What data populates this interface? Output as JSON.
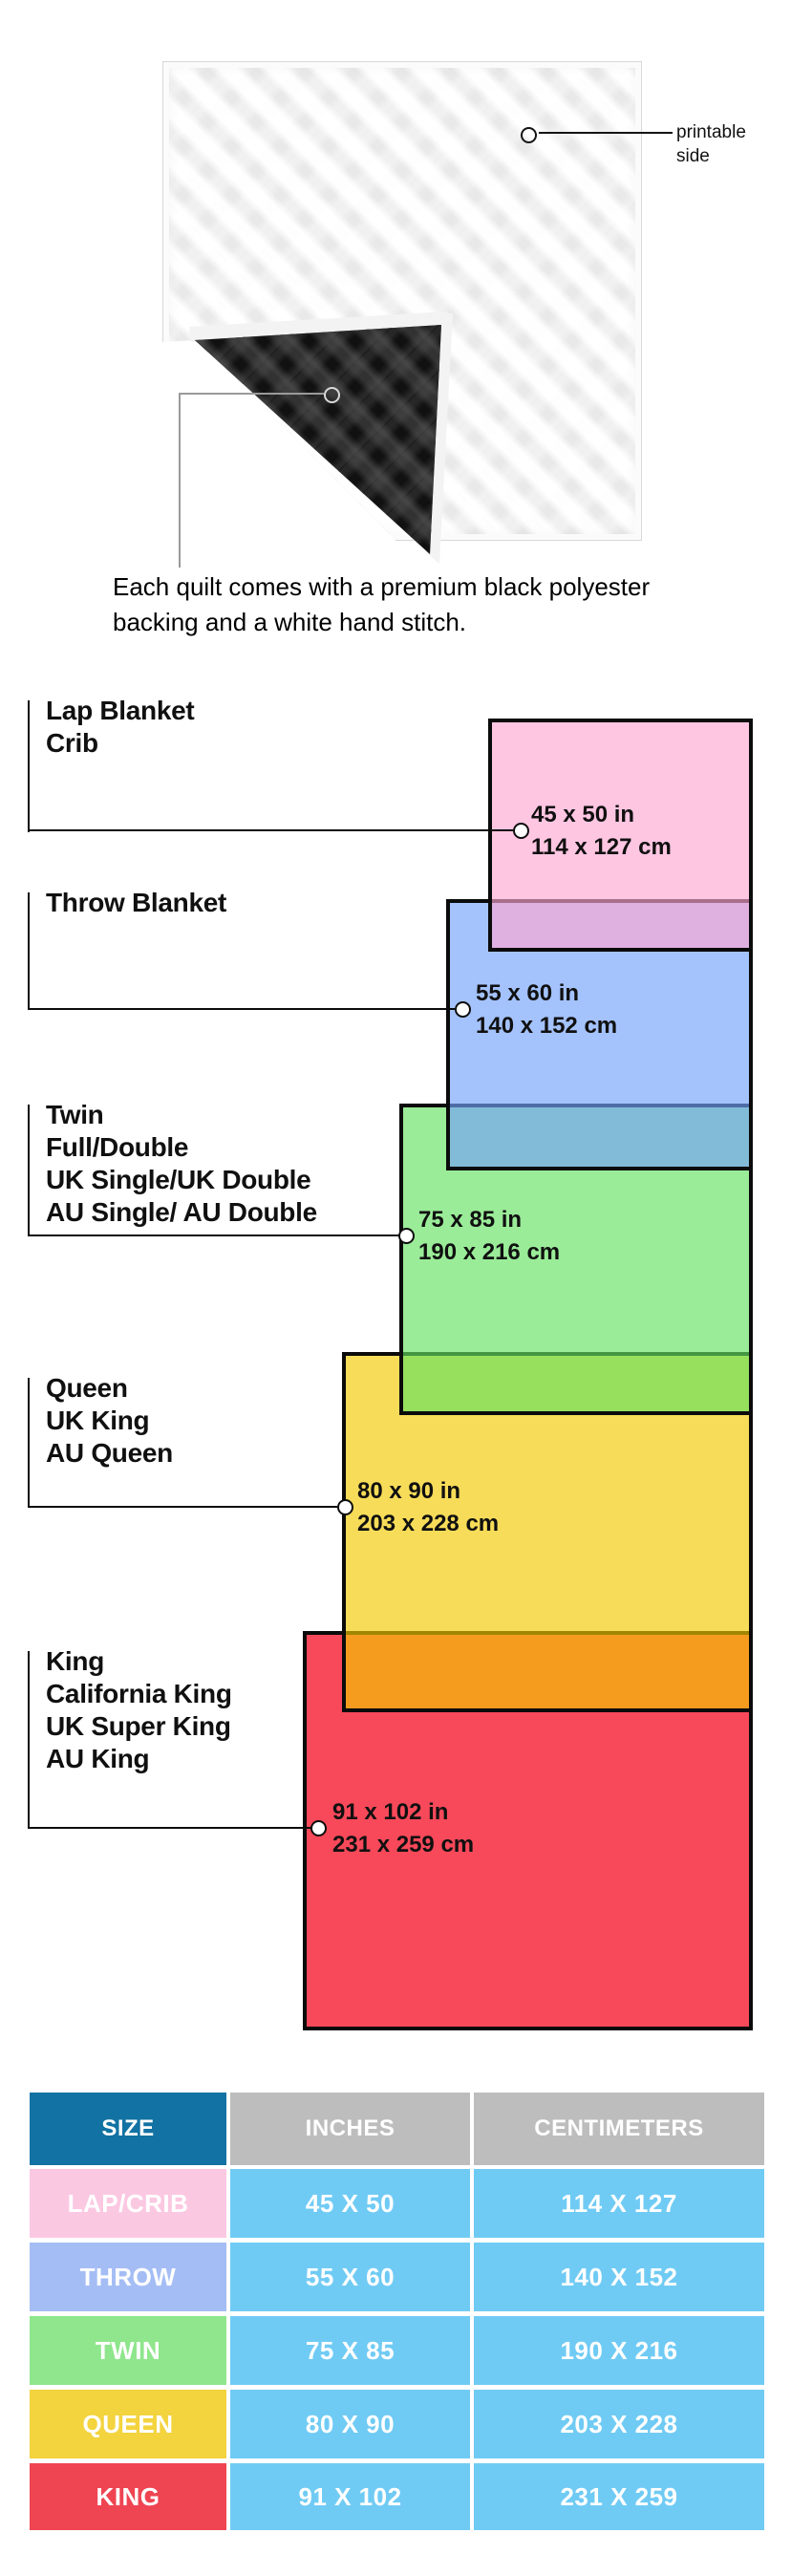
{
  "page": {
    "background": "#ffffff"
  },
  "quilt": {
    "printable_label": "printable side",
    "caption": "Each quilt comes with a premium black polyester backing and a white hand stitch.",
    "front_color": "#f7f7f7",
    "back_color": "#151515"
  },
  "diagram": {
    "items": [
      {
        "id": "lap",
        "heading": "Lap Blanket\nCrib",
        "size_label": "45 x 50 in\n114 x 127 cm",
        "fill": "rgba(255,167,210,0.65)"
      },
      {
        "id": "throw",
        "heading": "Throw Blanket",
        "size_label": "55 x 60 in\n140 x 152 cm",
        "fill": "rgba(115,161,250,0.65)"
      },
      {
        "id": "twin",
        "heading": "Twin\nFull/Double\nUK Single/UK Double\nAU Single/ AU Double",
        "size_label": "75 x 85 in\n190 x 216 cm",
        "fill": "rgba(100,226,97,0.65)"
      },
      {
        "id": "queen",
        "heading": "Queen\nUK King\nAU Queen",
        "size_label": "80 x 90 in\n203 x 228 cm",
        "fill": "rgba(243,201,0,0.65)"
      },
      {
        "id": "king",
        "heading": "King\nCalifornia King\nUK Super King\nAU King",
        "size_label": "91 x 102 in\n231 x 259 cm",
        "fill": "#F8495A"
      }
    ]
  },
  "table": {
    "headers": [
      {
        "label": "SIZE",
        "color": "#1272A3"
      },
      {
        "label": "INCHES",
        "color": "#BDBDBD"
      },
      {
        "label": "CENTIMETERS",
        "color": "#BDBDBD"
      }
    ],
    "rows": [
      {
        "label": "LAP/CRIB",
        "label_color": "#FBC8E2",
        "inches": "45 X 50",
        "centimeters": "114 X 127"
      },
      {
        "label": "THROW",
        "label_color": "#A5BDF5",
        "inches": "55 X 60",
        "centimeters": "140 X 152"
      },
      {
        "label": "TWIN",
        "label_color": "#8FE68C",
        "inches": "75 X 85",
        "centimeters": "190 X 216"
      },
      {
        "label": "QUEEN",
        "label_color": "#F3D33E",
        "inches": "80 X 90",
        "centimeters": "203 X 228"
      },
      {
        "label": "KING",
        "label_color": "#EF4452",
        "inches": "91 X 102",
        "centimeters": "231 X 259"
      }
    ],
    "cell_color": "#70CBF4",
    "text_color": "#ffffff"
  }
}
